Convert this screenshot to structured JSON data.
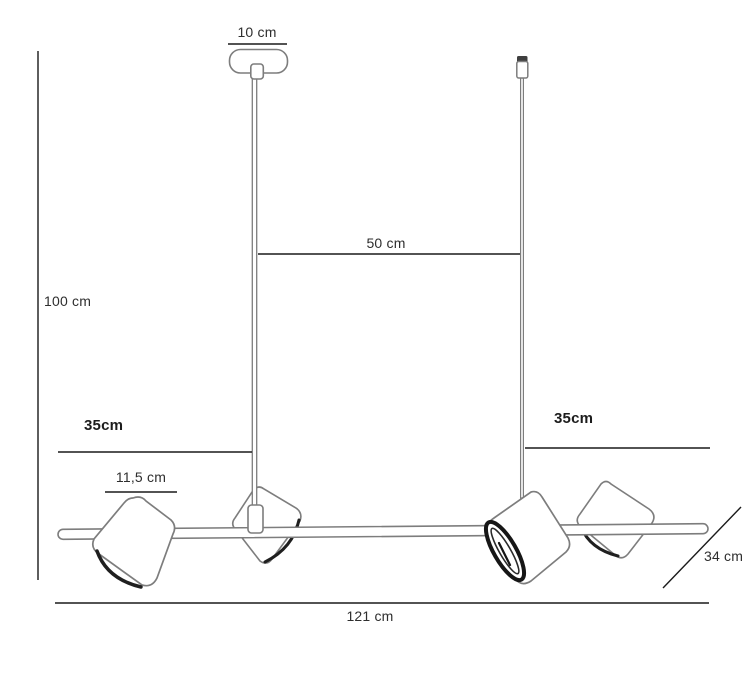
{
  "figure": {
    "type": "product-dimension-drawing",
    "colors": {
      "background": "#ffffff",
      "lamp_outline": "#7d7d7d",
      "dark_accent": "#1f1f1f",
      "dimension_line": "#1a1a1a",
      "label_text": "#2e2e2e"
    },
    "labels": {
      "canopy_width": "10 cm",
      "rod_spacing": "50 cm",
      "overall_height": "100 cm",
      "left_drop": "35cm",
      "shade_width": "11,5 cm",
      "right_drop": "35cm",
      "overall_width": "121 cm",
      "depth": "34 cm"
    }
  }
}
